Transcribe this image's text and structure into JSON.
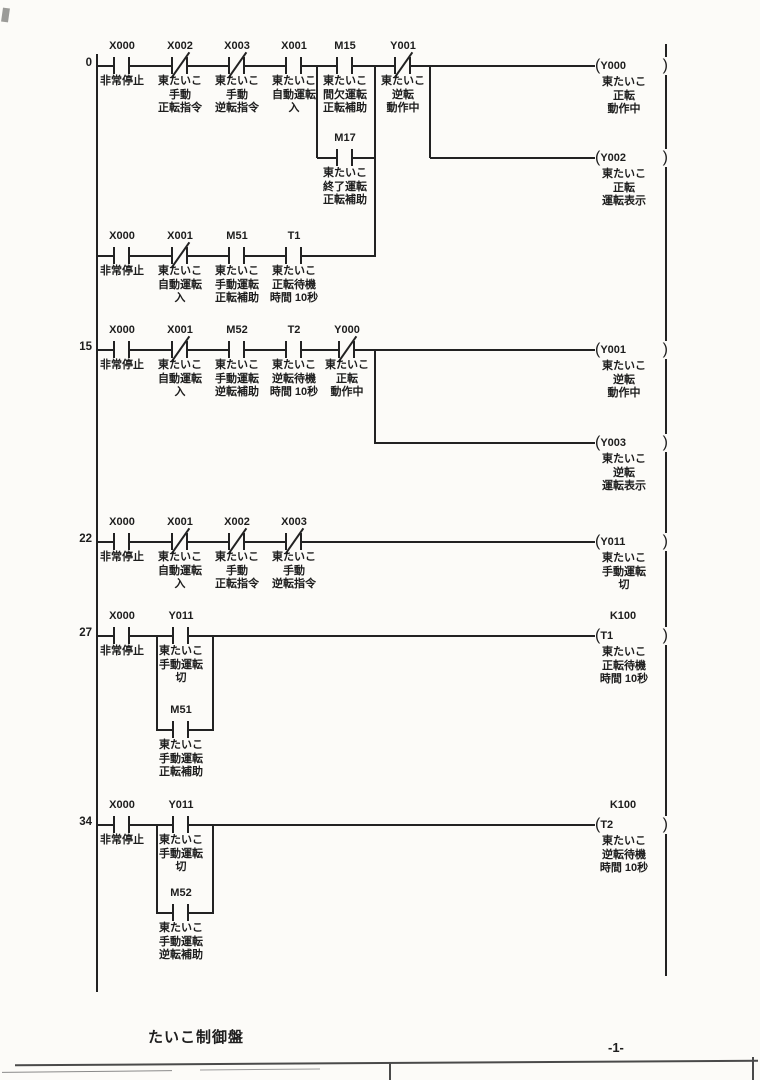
{
  "ladder": {
    "rows": [
      {
        "number": "0",
        "contacts": [
          {
            "device": "X000",
            "type": "NO",
            "label": "非常停止"
          },
          {
            "device": "X002",
            "type": "NC",
            "label": "東たいこ\n手動\n正転指令"
          },
          {
            "device": "X003",
            "type": "NC",
            "label": "東たいこ\n手動\n逆転指令"
          },
          {
            "device": "X001",
            "type": "NO",
            "label": "東たいこ\n自動運転\n入"
          },
          {
            "device": "M15",
            "type": "NO",
            "label": "東たいこ\n間欠運転\n正転補助"
          },
          {
            "device": "Y001",
            "type": "NC",
            "label": "東たいこ\n逆転\n動作中"
          }
        ]
      },
      {
        "number": "",
        "contacts": [
          {
            "device": "M17",
            "type": "NO",
            "label": "東たいこ\n終了運転\n正転補助"
          }
        ]
      },
      {
        "number": "",
        "contacts": [
          {
            "device": "X000",
            "type": "NO",
            "label": "非常停止"
          },
          {
            "device": "X001",
            "type": "NC",
            "label": "東たいこ\n自動運転\n入"
          },
          {
            "device": "M51",
            "type": "NO",
            "label": "東たいこ\n手動運転\n正転補助"
          },
          {
            "device": "T1",
            "type": "NO",
            "label": "東たいこ\n正転待機\n時間 10秒"
          }
        ]
      },
      {
        "number": "15",
        "contacts": [
          {
            "device": "X000",
            "type": "NO",
            "label": "非常停止"
          },
          {
            "device": "X001",
            "type": "NC",
            "label": "東たいこ\n自動運転\n入"
          },
          {
            "device": "M52",
            "type": "NO",
            "label": "東たいこ\n手動運転\n逆転補助"
          },
          {
            "device": "T2",
            "type": "NO",
            "label": "東たいこ\n逆転待機\n時間 10秒"
          },
          {
            "device": "Y000",
            "type": "NC",
            "label": "東たいこ\n正転\n動作中"
          }
        ]
      },
      {
        "number": "22",
        "contacts": [
          {
            "device": "X000",
            "type": "NO",
            "label": "非常停止"
          },
          {
            "device": "X001",
            "type": "NC",
            "label": "東たいこ\n自動運転\n入"
          },
          {
            "device": "X002",
            "type": "NC",
            "label": "東たいこ\n手動\n正転指令"
          },
          {
            "device": "X003",
            "type": "NC",
            "label": "東たいこ\n手動\n逆転指令"
          }
        ]
      },
      {
        "number": "27",
        "contacts": [
          {
            "device": "X000",
            "type": "NO",
            "label": "非常停止"
          },
          {
            "device": "Y011",
            "type": "NO",
            "label": "東たいこ\n手動運転\n切"
          }
        ]
      },
      {
        "number": "",
        "contacts": [
          {
            "device": "M51",
            "type": "NO",
            "label": "東たいこ\n手動運転\n正転補助"
          }
        ]
      },
      {
        "number": "34",
        "contacts": [
          {
            "device": "X000",
            "type": "NO",
            "label": "非常停止"
          },
          {
            "device": "Y011",
            "type": "NO",
            "label": "東たいこ\n手動運転\n切"
          }
        ]
      },
      {
        "number": "",
        "contacts": [
          {
            "device": "M52",
            "type": "NO",
            "label": "東たいこ\n手動運転\n逆転補助"
          }
        ]
      }
    ],
    "coils": [
      {
        "device": "Y000",
        "open": "(",
        "close": ")",
        "label": "東たいこ\n正転\n動作中"
      },
      {
        "device": "Y002",
        "open": "(",
        "close": ")",
        "label": "東たいこ\n正転\n運転表示"
      },
      {
        "device": "Y001",
        "open": "(",
        "close": ")",
        "label": "東たいこ\n逆転\n動作中"
      },
      {
        "device": "Y003",
        "open": "(",
        "close": ")",
        "label": "東たいこ\n逆転\n運転表示"
      },
      {
        "device": "Y011",
        "open": "(",
        "close": ")",
        "label": "東たいこ\n手動運転\n切"
      },
      {
        "device": "T1",
        "open": "(",
        "close": ")",
        "preset": "K100",
        "label": "東たいこ\n正転待機\n時間 10秒"
      },
      {
        "device": "T2",
        "open": "(",
        "close": ")",
        "preset": "K100",
        "label": "東たいこ\n逆転待機\n時間 10秒"
      }
    ]
  },
  "footer": {
    "panel_name": "たいこ制御盤",
    "page_number": "-1-"
  },
  "colors": {
    "ink": "#222222",
    "paper": "#fcfbf8"
  }
}
